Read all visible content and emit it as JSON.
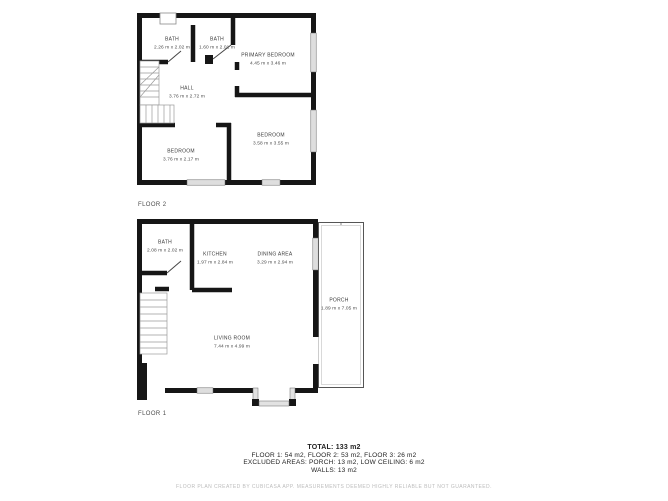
{
  "colors": {
    "wall": "#161616",
    "window_fill": "#dedede",
    "porch_outline": "#555555",
    "label_text": "#3a3a3a",
    "muted_text": "#bcbcbc"
  },
  "floors": [
    {
      "label": "FLOOR 2",
      "rooms": [
        {
          "name": "BATH",
          "dims": "2.26 m x 2.02 m"
        },
        {
          "name": "BATH",
          "dims": "1.60 m x 2.01 m"
        },
        {
          "name": "PRIMARY BEDROOM",
          "dims": "4.45 m x 3.46 m"
        },
        {
          "name": "HALL",
          "dims": "3.76 m x 2.72 m"
        },
        {
          "name": "BEDROOM",
          "dims": "3.76 m x 2.17 m"
        },
        {
          "name": "BEDROOM",
          "dims": "3.58 m x 3.55 m"
        }
      ]
    },
    {
      "label": "FLOOR 1",
      "rooms": [
        {
          "name": "BATH",
          "dims": "2.08 m x 2.02 m"
        },
        {
          "name": "KITCHEN",
          "dims": "1.97 m x 2.84 m"
        },
        {
          "name": "DINING AREA",
          "dims": "3.29 m x 2.94 m"
        },
        {
          "name": "LIVING ROOM",
          "dims": "7.44 m x 4.99 m"
        },
        {
          "name": "PORCH",
          "dims": "1.89 m x 7.05 m"
        }
      ]
    }
  ],
  "summary": {
    "total": "TOTAL: 133 m2",
    "floors_line": "FLOOR 1: 54 m2, FLOOR 2: 53 m2, FLOOR 3: 26 m2",
    "excluded_line": "EXCLUDED AREAS: PORCH: 13 m2, LOW CEILING: 6 m2",
    "walls_line": "WALLS: 13 m2"
  },
  "footer": "FLOOR PLAN CREATED BY CUBICASA APP. MEASUREMENTS DEEMED HIGHLY RELIABLE BUT NOT GUARANTEED."
}
